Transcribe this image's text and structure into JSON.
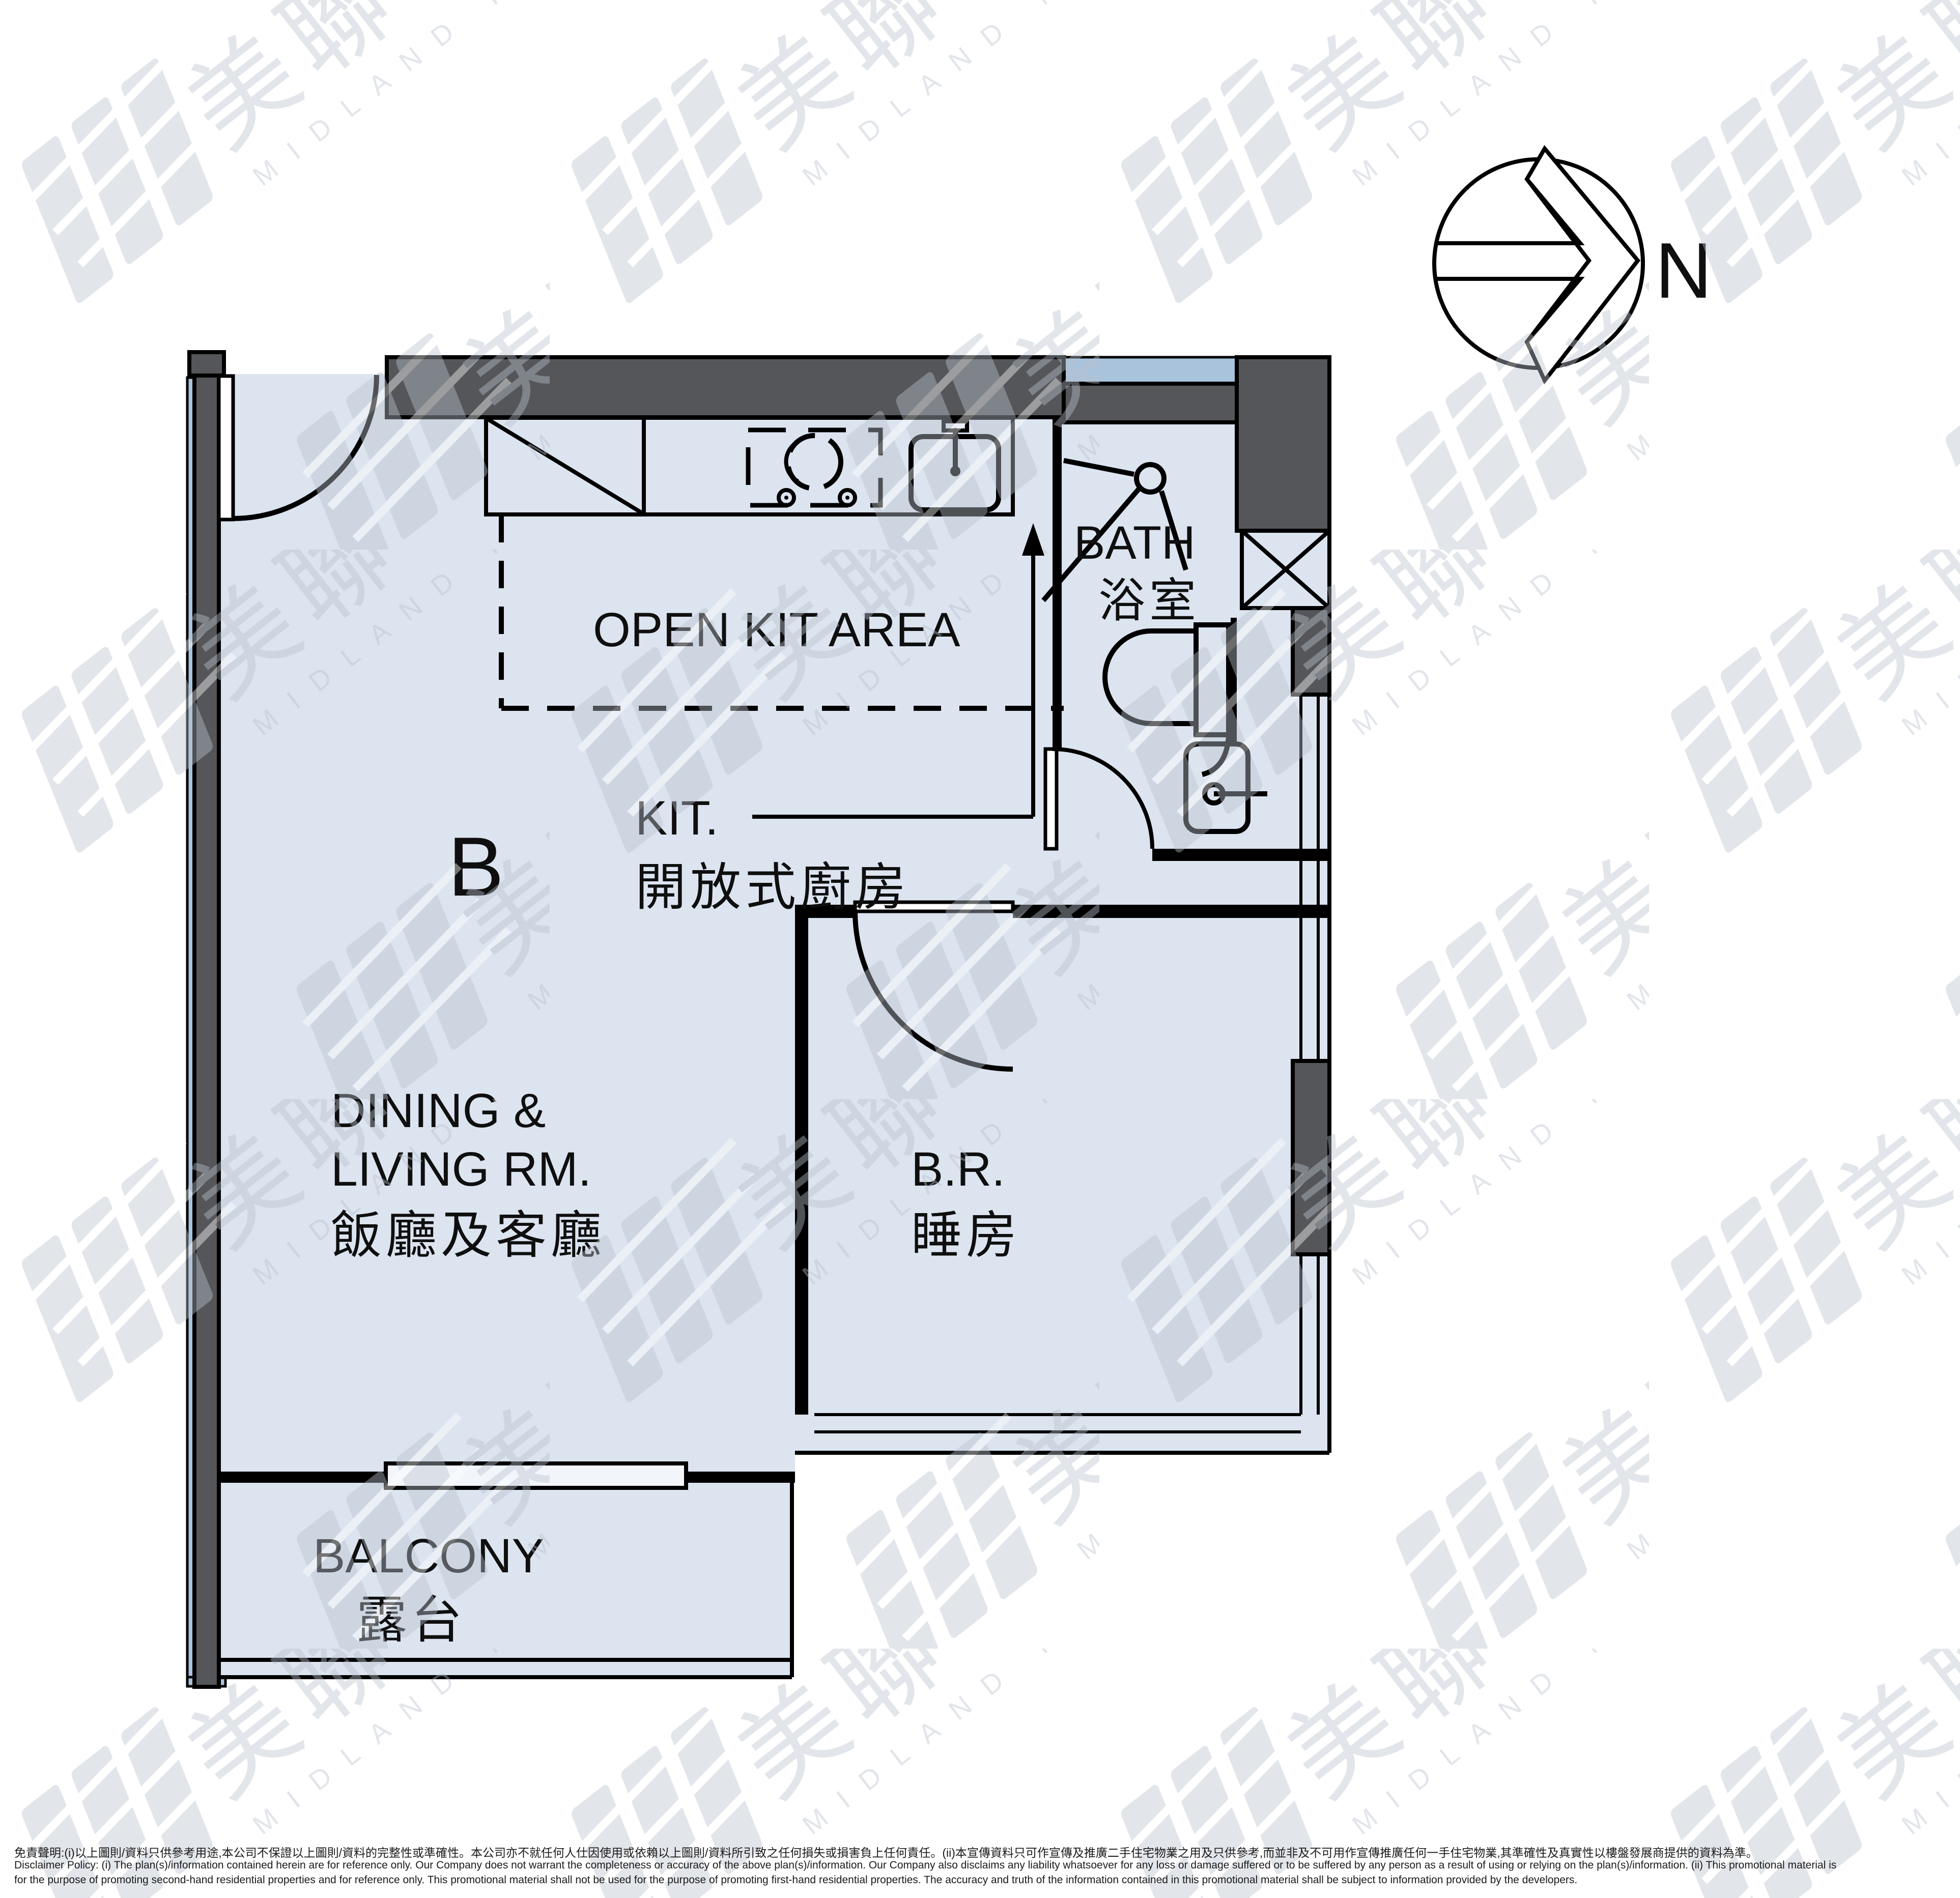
{
  "compass": {
    "north": "N"
  },
  "plan": {
    "unit": "B",
    "open_kit_area": "OPEN KIT AREA",
    "kit_en": "KIT.",
    "kit_zh": "開放式廚房",
    "bath_en": "BATH",
    "bath_zh": "浴室",
    "dining_en1": "DINING &",
    "dining_en2": "LIVING RM.",
    "dining_zh": "飯廳及客廳",
    "br_en": "B.R.",
    "br_zh": "睡房",
    "balcony_en": "BALCONY",
    "balcony_zh": "露台"
  },
  "watermark": {
    "cjk": "美聯物業",
    "latin": "MIDLAND REALTY"
  },
  "disclaimer": {
    "zh": "免責聲明:(i)以上圖則/資料只供參考用途,本公司不保證以上圖則/資料的完整性或準確性。本公司亦不就任何人仕因使用或依賴以上圖則/資料所引致之任何損失或損害負上任何責任。(ii)本宣傳資料只可作宣傳及推廣二手住宅物業之用及只供參考,而並非及不可用作宣傳推廣任何一手住宅物業,其準確性及真實性以樓盤發展商提供的資料為準。",
    "en1": "Disclaimer Policy: (i) The plan(s)/information contained herein are for reference only. Our Company does not warrant the completeness or accuracy of the above plan(s)/information. Our Company also disclaims any liability whatsoever for any loss or damage suffered or to be suffered by any person as a result of using or relying on the plan(s)/information. (ii) This promotional material is",
    "en2": "for the purpose of promoting second-hand residential properties and for reference only. This promotional material shall not be used for the purpose of promoting first-hand residential properties. The accuracy and truth of the information contained in this promotional material shall be subject to information provided by the developers."
  },
  "colors": {
    "room": "#dce4f0",
    "wall": "#55565a",
    "winblue": "#a9c3dd",
    "wm": "#b9c0cd",
    "ink": "#0f0f0f"
  }
}
